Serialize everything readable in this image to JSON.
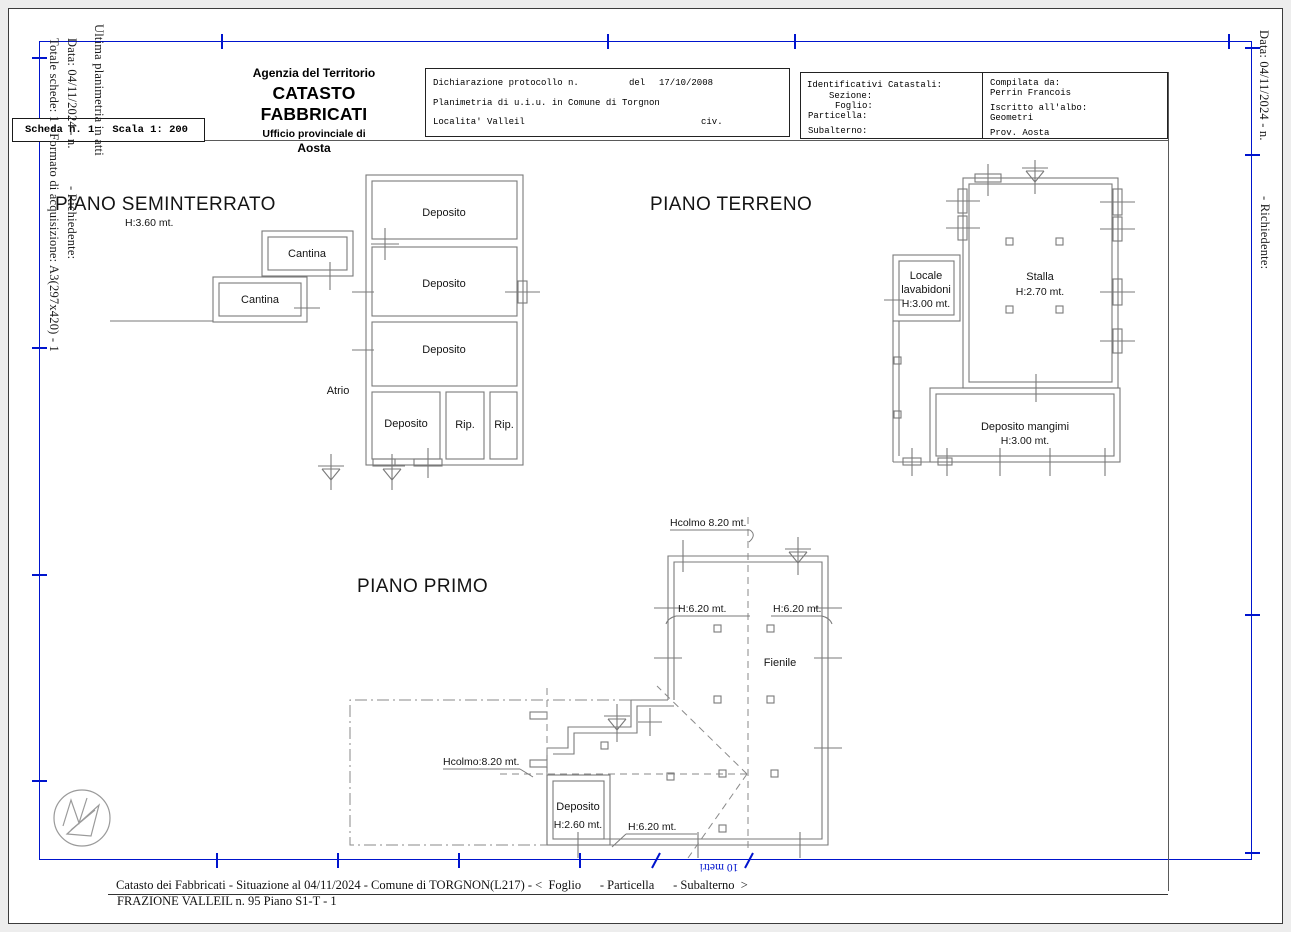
{
  "header": {
    "agency": {
      "line1": "Agenzia del Territorio",
      "line2": "CATASTO FABBRICATI",
      "line3": "Ufficio provinciale di",
      "line4": "Aosta"
    },
    "declaration": {
      "protocol_label": "Dichiarazione protocollo n.",
      "del_label": "del",
      "date": "17/10/2008",
      "line2": "Planimetria di u.i.u. in Comune di Torgnon",
      "location_label": "Localita' Valleil",
      "civ_label": "civ."
    },
    "catastali": {
      "title": "Identificativi Catastali:",
      "sezione": "Sezione:",
      "foglio": "Foglio:",
      "particella": "Particella:",
      "subalterno": "Subalterno:"
    },
    "compiler": {
      "label": "Compilata da:",
      "name": "Perrin Francois",
      "albo_label": "Iscritto all'albo:",
      "albo_value": "Geometri",
      "prov": "Prov. Aosta"
    }
  },
  "scheda": {
    "label": "Scheda n. 1",
    "scala": "Scala 1: 200"
  },
  "margins": {
    "left_totale": "Totale schede: 1 - Formato di acquisizione: A3(297x420) - 1",
    "left_data": "Data: 04/11/2024 - n.",
    "left_richiedente": "- Richiedente:",
    "left_ultima": "Ultima planimetria in atti",
    "right_data": "Data: 04/11/2024 - n.",
    "right_richiedente": "- Richiedente:"
  },
  "plans": {
    "seminterrato": {
      "title": "PIANO SEMINTERRATO",
      "height": "H:3.60 mt.",
      "deposito1": "Deposito",
      "deposito2": "Deposito",
      "deposito3": "Deposito",
      "deposito4": "Deposito",
      "rip1": "Rip.",
      "rip2": "Rip.",
      "cantina1": "Cantina",
      "cantina2": "Cantina",
      "atrio": "Atrio"
    },
    "terreno": {
      "title": "PIANO TERRENO",
      "stalla": "Stalla",
      "stalla_h": "H:2.70 mt.",
      "locale_line1": "Locale",
      "locale_line2": "lavabidoni",
      "locale_h": "H:3.00 mt.",
      "mangimi": "Deposito mangimi",
      "mangimi_h": "H:3.00 mt."
    },
    "primo": {
      "title": "PIANO PRIMO",
      "hcolmo_top": "Hcolmo 8.20 mt.",
      "hcolmo_left": "Hcolmo:8.20 mt.",
      "h620_left": "H:6.20 mt.",
      "h620_right": "H:6.20 mt.",
      "h620_bottom": "H:6.20 mt.",
      "fienile": "Fienile",
      "deposito": "Deposito",
      "deposito_h": "H:2.60 mt."
    }
  },
  "footer": {
    "line1": "Catasto dei Fabbricati - Situazione al 04/11/2024 - Comune di TORGNON(L217) - <  Foglio      - Particella      - Subalterno  >",
    "line2": "FRAZIONE VALLEIL n. 95 Piano S1-T - 1"
  },
  "scale_bar": {
    "label": "10 metri"
  },
  "colors": {
    "frame_blue": "#0014cd",
    "line_gray": "#7a7a7a",
    "text_black": "#141414"
  }
}
